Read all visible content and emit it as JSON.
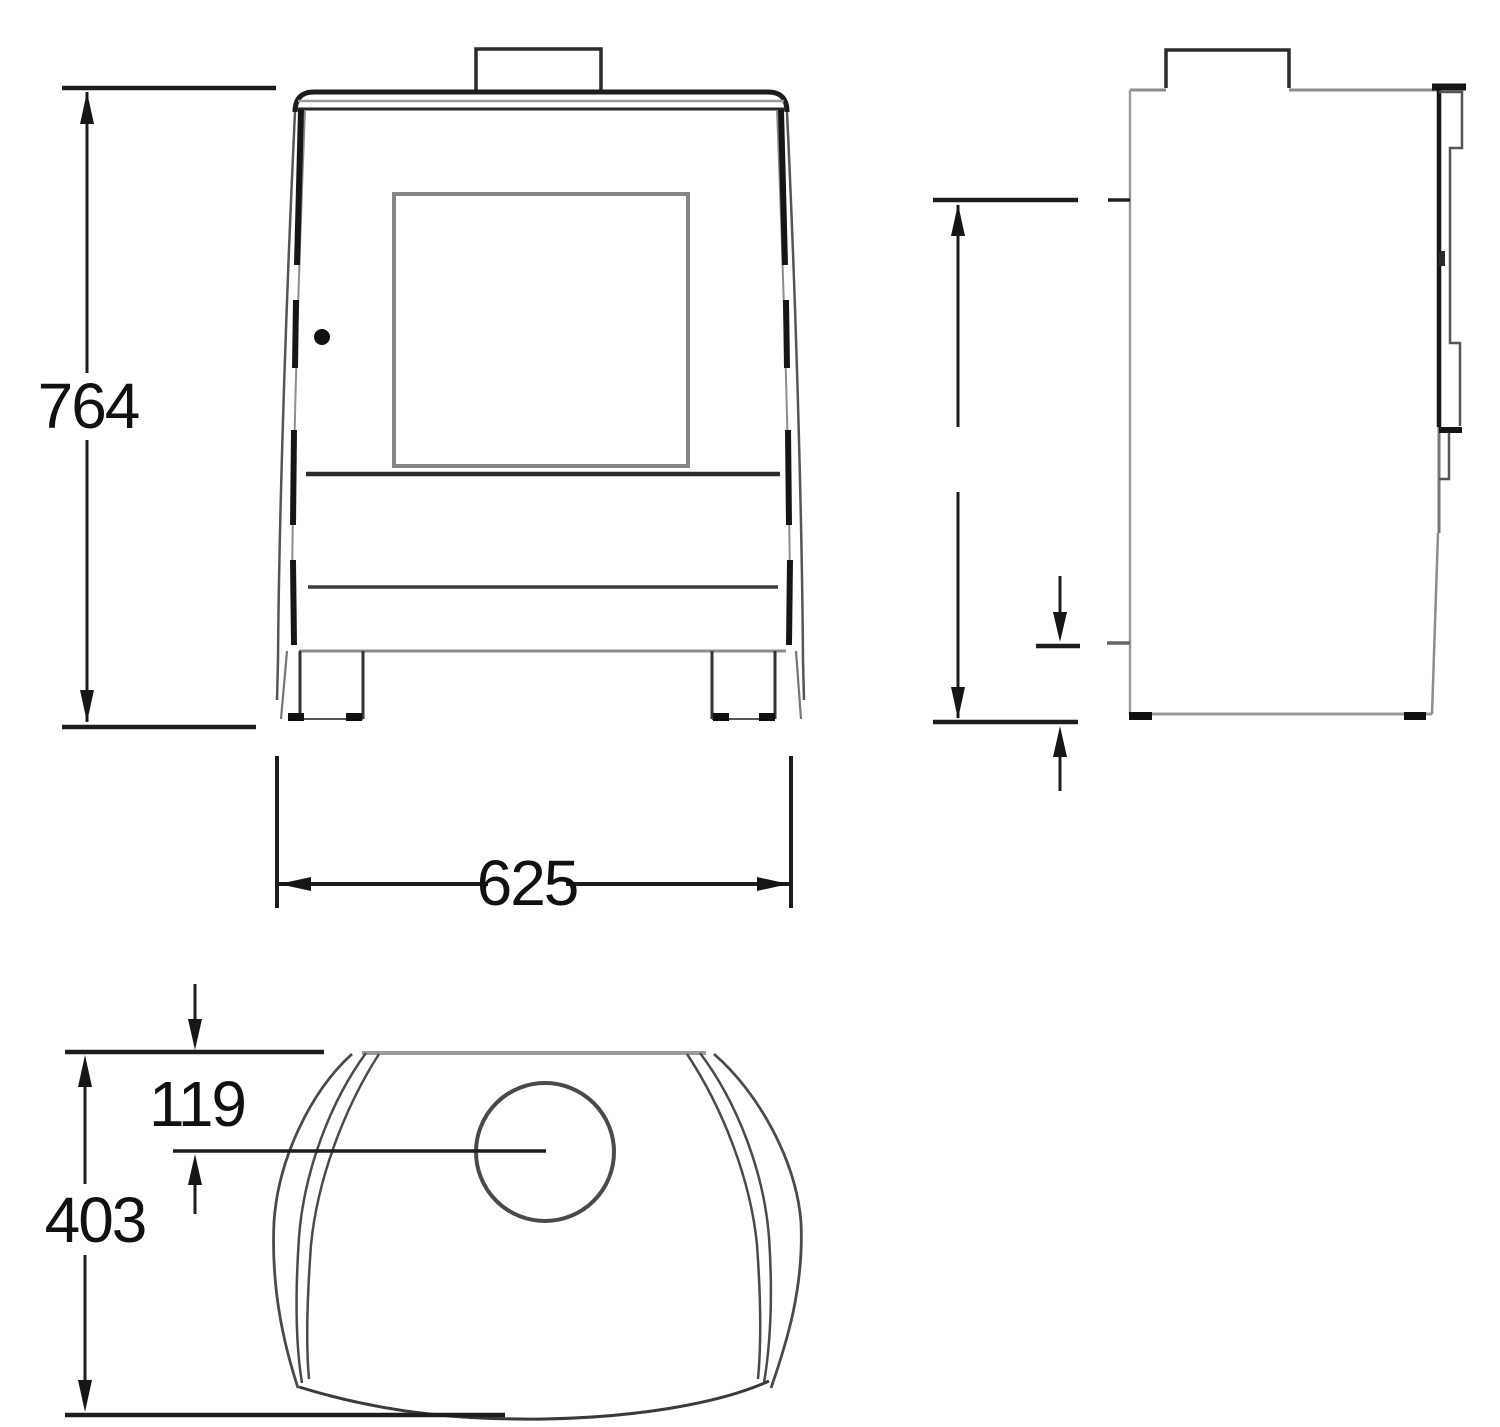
{
  "colors": {
    "background": "#ffffff",
    "line_dark": "#1d1d1d",
    "line_gray": "#8d8d8d",
    "text": "#111111"
  },
  "dimensions": {
    "front_height": "764",
    "front_width": "625",
    "top_flue_offset": "119",
    "top_depth": "403"
  }
}
